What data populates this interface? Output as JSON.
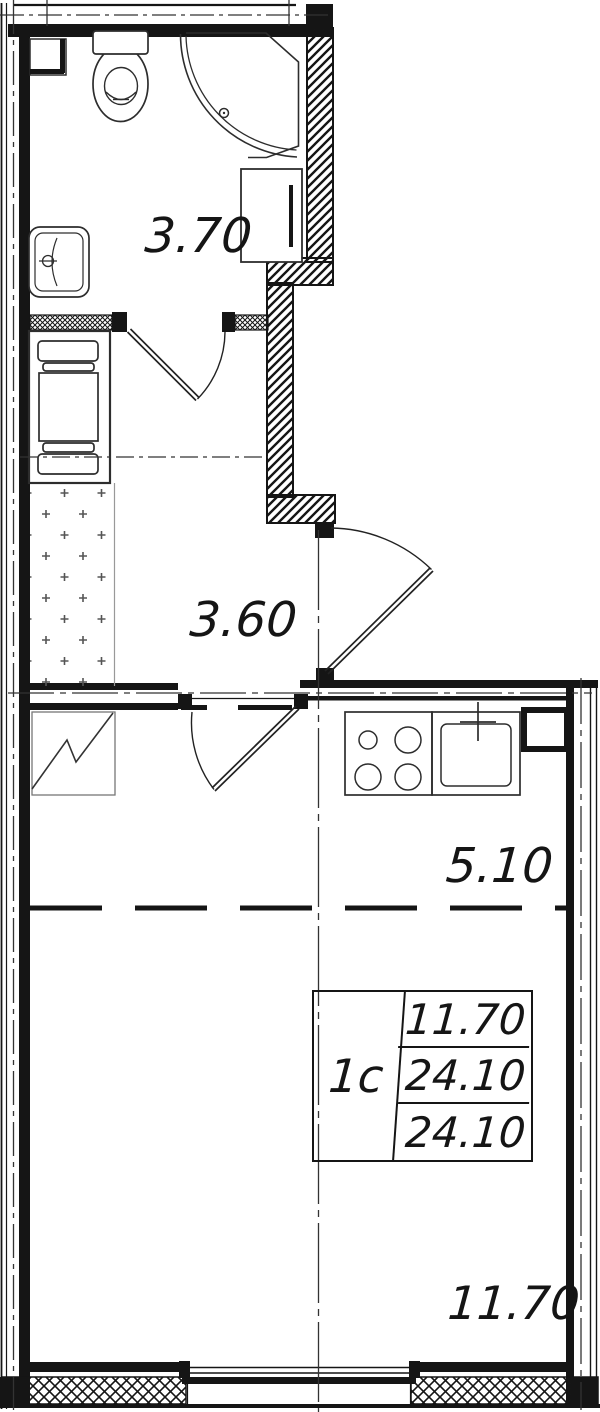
{
  "plan": {
    "background_color": "#ffffff",
    "wall_color": "#151515",
    "fixture_color": "#3c3c3c",
    "rooms": [
      {
        "name": "bathroom",
        "area": "3.70"
      },
      {
        "name": "hallway",
        "area": "3.60"
      },
      {
        "name": "kitchen-zone",
        "area": "5.10"
      },
      {
        "name": "living-zone",
        "area": "11.70"
      }
    ],
    "info_table": {
      "apartment_type": "1с",
      "rows": [
        "11.70",
        "24.10",
        "24.10"
      ]
    }
  }
}
